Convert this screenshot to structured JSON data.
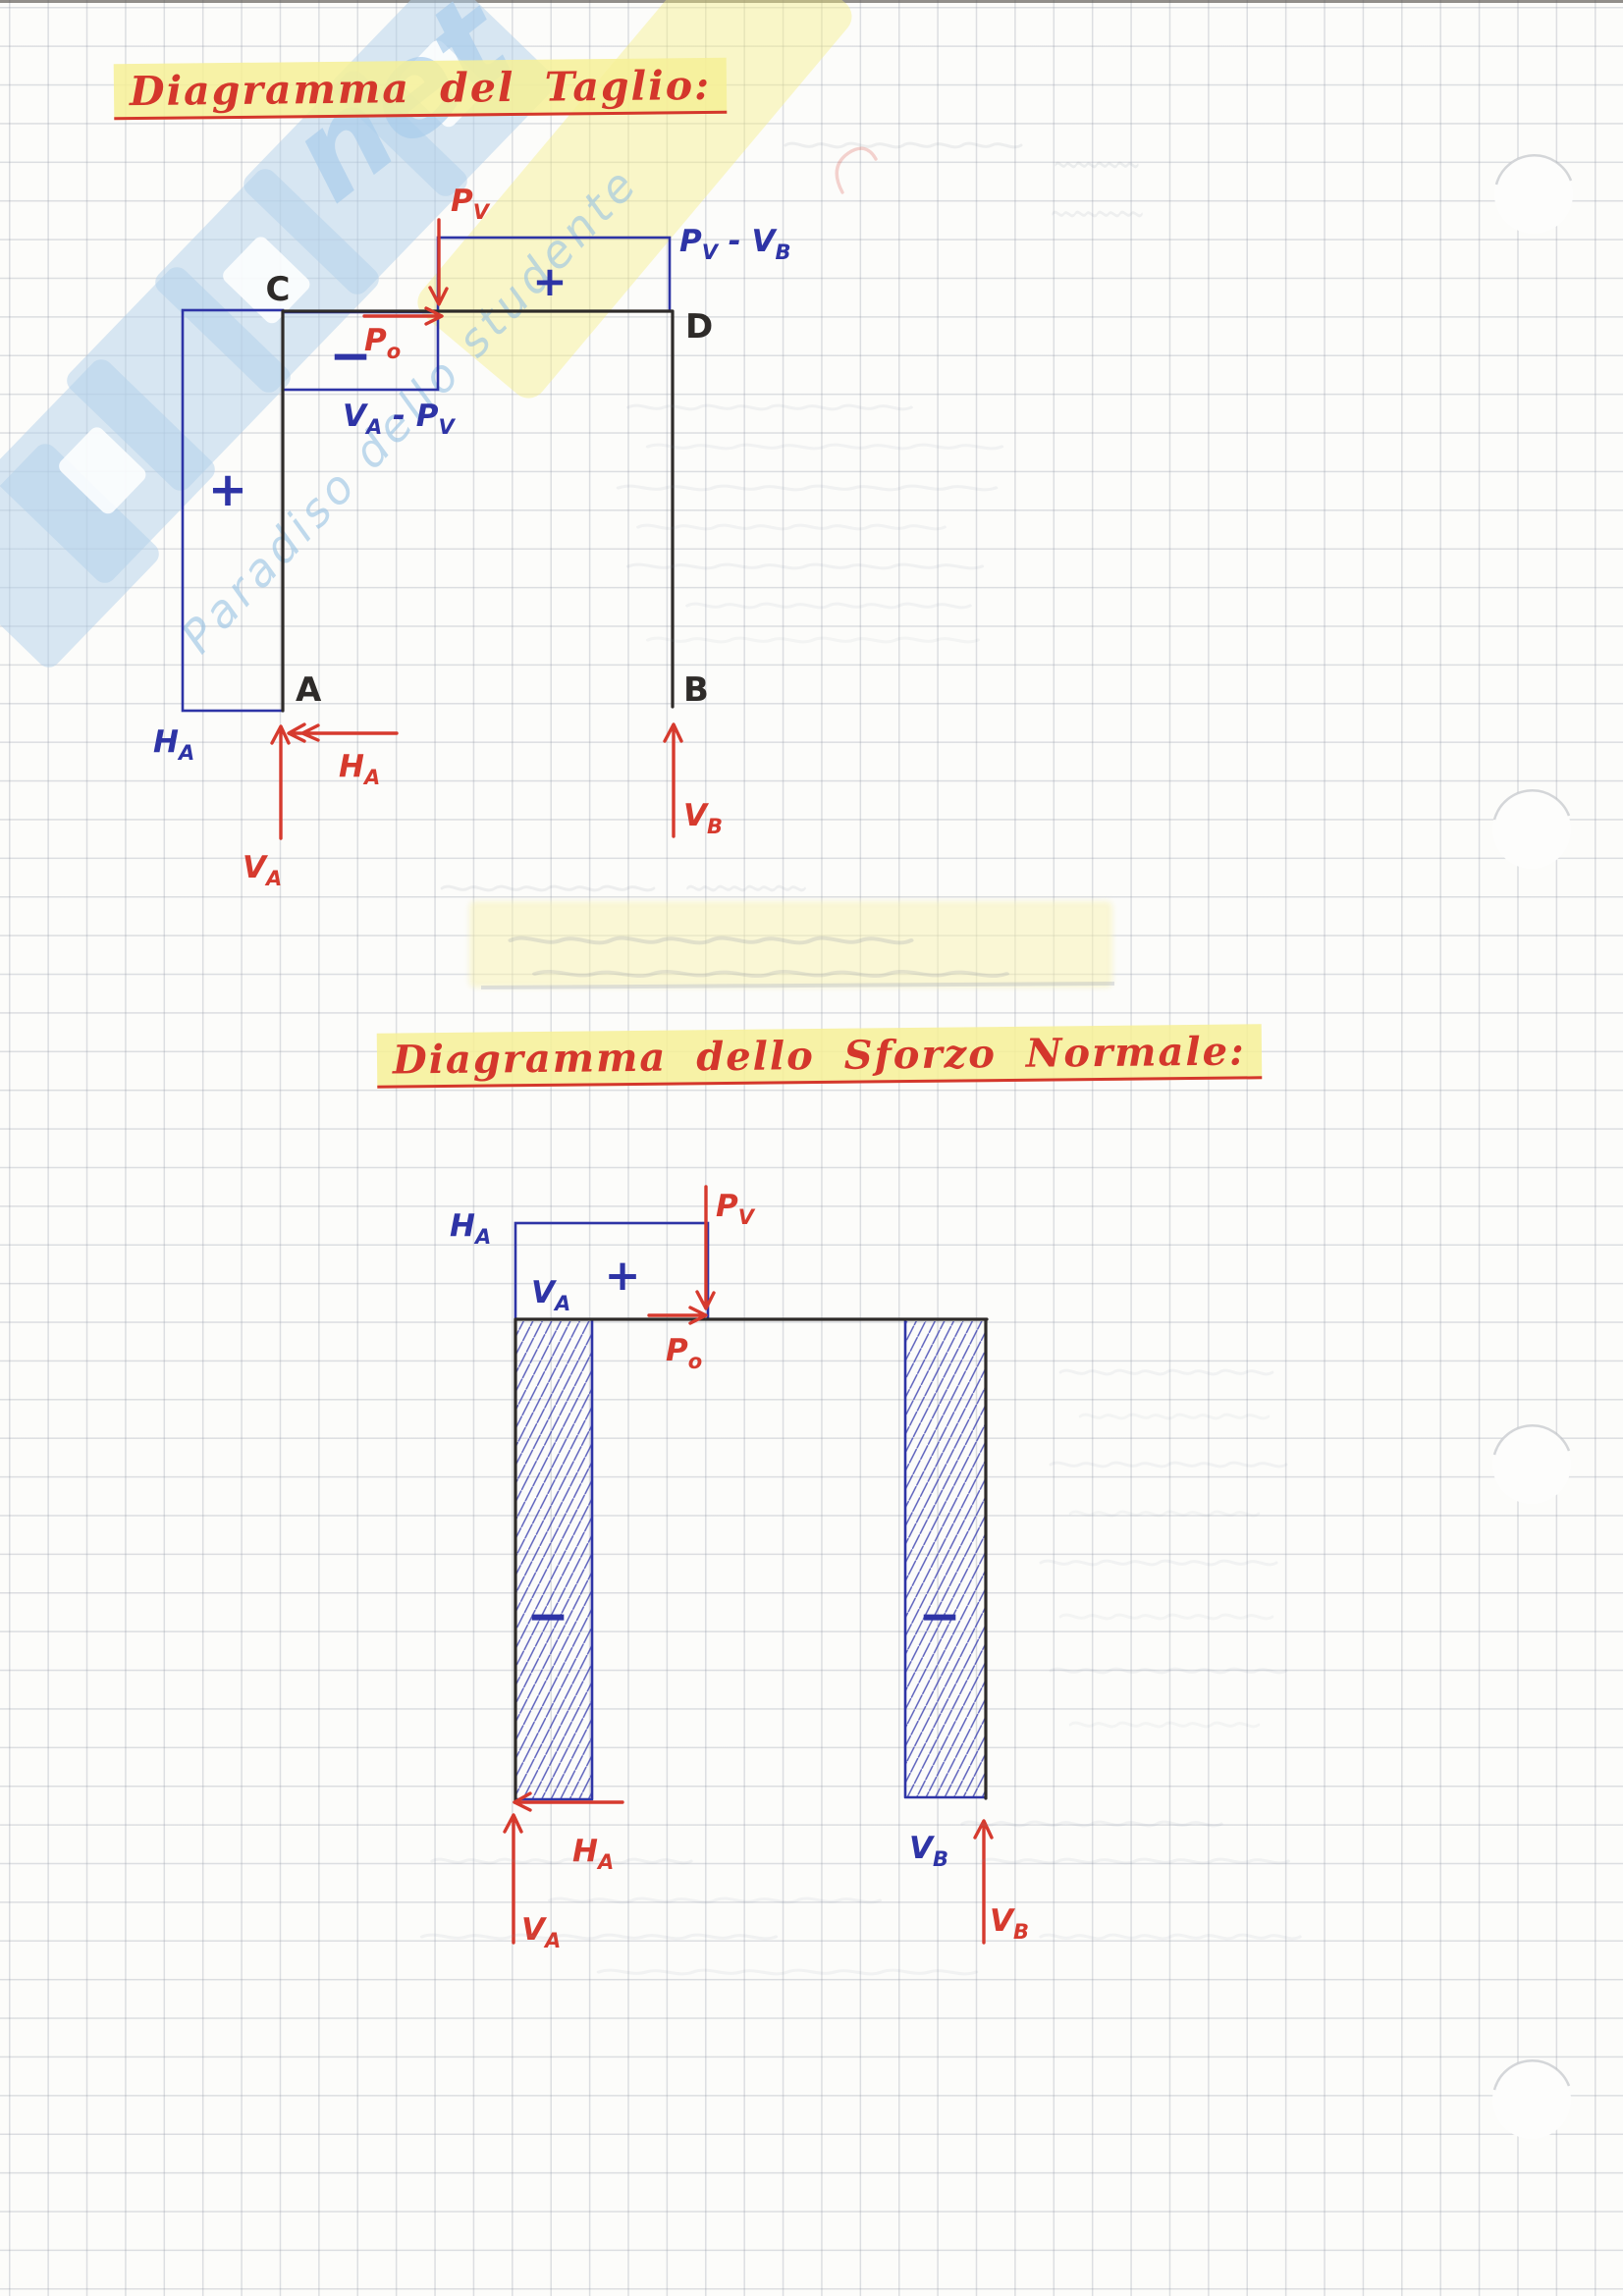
{
  "page": {
    "kind": "Squared notebook page - handwritten structural analysis notes"
  },
  "titles": {
    "shear": "Diagramma del Taglio:",
    "normal": "Diagramma dello Sforzo Normale:"
  },
  "watermark": {
    "logo_script": "net",
    "tagline": "Paradiso dello studente"
  },
  "colors": {
    "pen_red": "#d63a2e",
    "pen_blue": "#2e34a6",
    "pen_black": "#2e2b29",
    "highlight_yellow": "#f6f096",
    "watermark_blue": "#b2d0e9",
    "grid_gray": "#9298a6"
  },
  "shear_diagram": {
    "nodes": {
      "c": "C",
      "d": "D",
      "a": "A",
      "b": "B"
    },
    "signs": {
      "column_plus": "+",
      "beam_minus": "−",
      "beam_plus": "+"
    },
    "forces": {
      "pv": {
        "b": "P",
        "s": "V"
      },
      "po": {
        "b": "P",
        "s": "o"
      },
      "pv_minus_vb": {
        "b1": "P",
        "s1": "V",
        "b2": " - V",
        "s2": "B"
      },
      "va_minus_pv": {
        "b1": "V",
        "s1": "A",
        "b2": " - P",
        "s2": "V"
      },
      "ha_support": {
        "b": "H",
        "s": "A"
      },
      "ha_reaction": {
        "b": "H",
        "s": "A"
      },
      "va_reaction": {
        "b": "V",
        "s": "A"
      },
      "vb_reaction": {
        "b": "V",
        "s": "B"
      }
    }
  },
  "normal_diagram": {
    "signs": {
      "beam_plus": "+",
      "left_column_minus": "−",
      "right_column_minus": "−"
    },
    "forces": {
      "ha_support": {
        "b": "H",
        "s": "A"
      },
      "va_value": {
        "b": "V",
        "s": "A"
      },
      "pv": {
        "b": "P",
        "s": "V"
      },
      "po": {
        "b": "P",
        "s": "o"
      },
      "vb_value": {
        "b": "V",
        "s": "B"
      },
      "ha_reaction": {
        "b": "H",
        "s": "A"
      },
      "va_reaction": {
        "b": "V",
        "s": "A"
      },
      "vb_reaction": {
        "b": "V",
        "s": "B"
      }
    }
  }
}
